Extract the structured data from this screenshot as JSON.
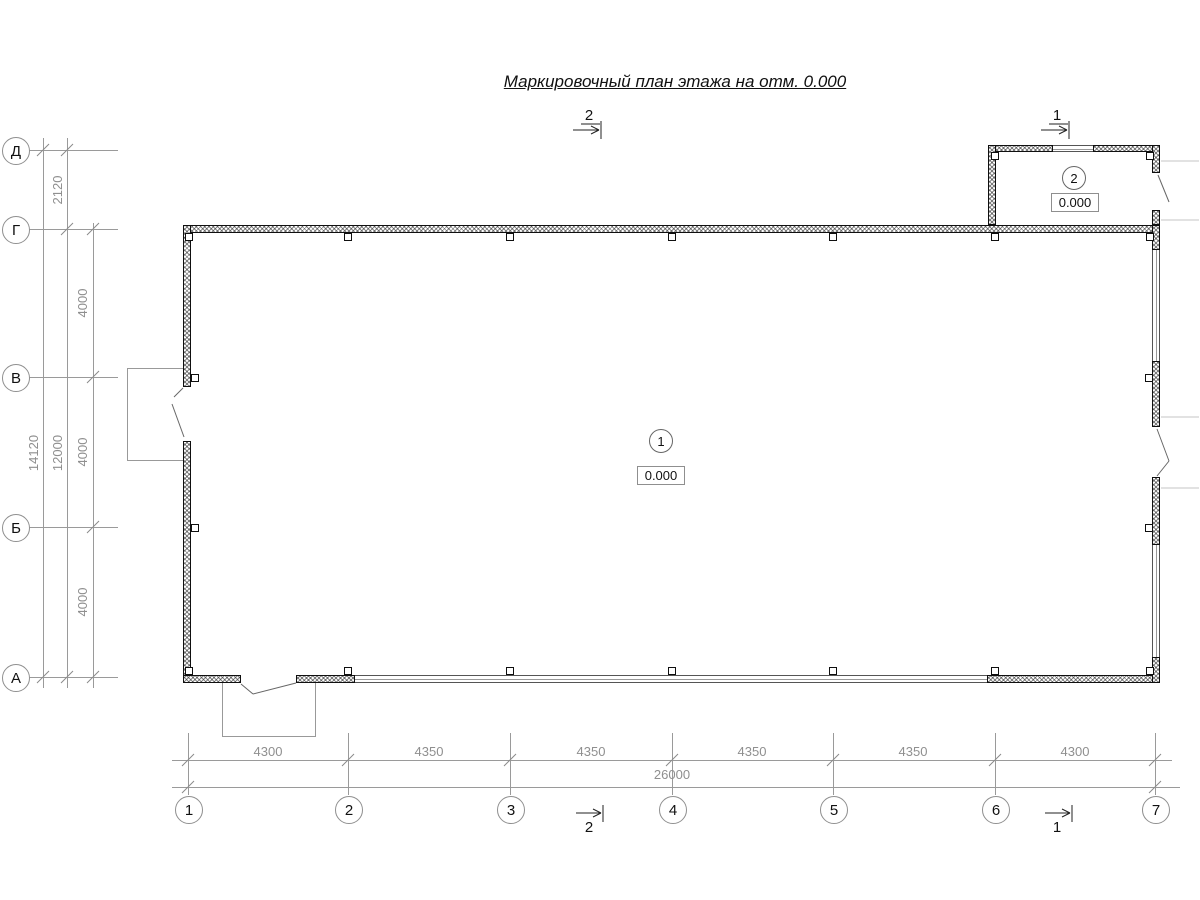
{
  "title": "Маркировочный план этажа на отм. 0.000",
  "axes": {
    "rows": [
      {
        "label": "Д"
      },
      {
        "label": "Г"
      },
      {
        "label": "В"
      },
      {
        "label": "Б"
      },
      {
        "label": "А"
      }
    ],
    "cols": [
      {
        "label": "1"
      },
      {
        "label": "2"
      },
      {
        "label": "3"
      },
      {
        "label": "4"
      },
      {
        "label": "5"
      },
      {
        "label": "6"
      },
      {
        "label": "7"
      }
    ]
  },
  "dims": {
    "left": {
      "d_g": "2120",
      "g_v": "4000",
      "v_b": "4000",
      "b_a": "4000",
      "g_a_total": "12000",
      "d_a_total": "14120"
    },
    "bottom": [
      "4300",
      "4350",
      "4350",
      "4350",
      "4350",
      "4300"
    ],
    "bottom_total": "26000"
  },
  "rooms": [
    {
      "number": "1",
      "level": "0.000"
    },
    {
      "number": "2",
      "level": "0.000"
    }
  ],
  "sections": {
    "top_2": "2",
    "top_1": "1",
    "bottom_2": "2",
    "bottom_1": "1"
  },
  "colors": {
    "wall_line": "#0f0f0f",
    "dim_line": "#9a9a9a",
    "dim_text": "#8f8f8f",
    "text": "#111111"
  }
}
